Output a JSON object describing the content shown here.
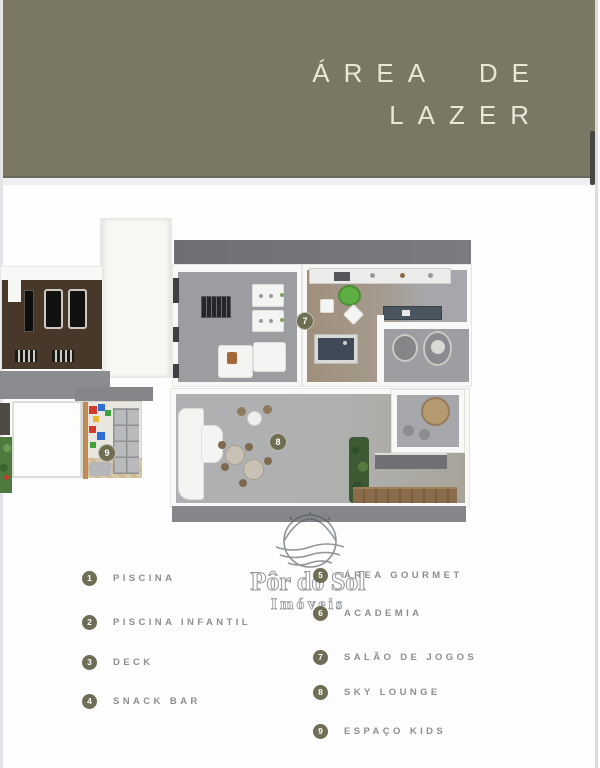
{
  "banner": {
    "line1": "ÁREA DE",
    "line2": "LAZER"
  },
  "watermark": {
    "name": "Pôr do Sol",
    "sub": "Imóveis"
  },
  "plan": {
    "badges": [
      {
        "num": "7",
        "label": "SALÃO DE JOGOS"
      },
      {
        "num": "8",
        "label": "SKY LOUNGE"
      },
      {
        "num": "9",
        "label": "ESPAÇO KIDS"
      }
    ]
  },
  "legend": {
    "items": [
      {
        "num": "1",
        "label": "PISCINA"
      },
      {
        "num": "2",
        "label": "PISCINA INFANTIL"
      },
      {
        "num": "3",
        "label": "DECK"
      },
      {
        "num": "4",
        "label": "SNACK BAR"
      },
      {
        "num": "5",
        "label": "ÁREA GOURMET"
      },
      {
        "num": "6",
        "label": "ACADEMIA"
      },
      {
        "num": "7",
        "label": "SALÃO DE JOGOS"
      },
      {
        "num": "8",
        "label": "SKY LOUNGE"
      },
      {
        "num": "9",
        "label": "ESPAÇO KIDS"
      }
    ]
  },
  "colors": {
    "banner_olive": "#7a7765",
    "banner_text_cream": "#ebe7d7",
    "badge_olive": "#6f6d52",
    "legend_gray": "#8e8e8e"
  }
}
